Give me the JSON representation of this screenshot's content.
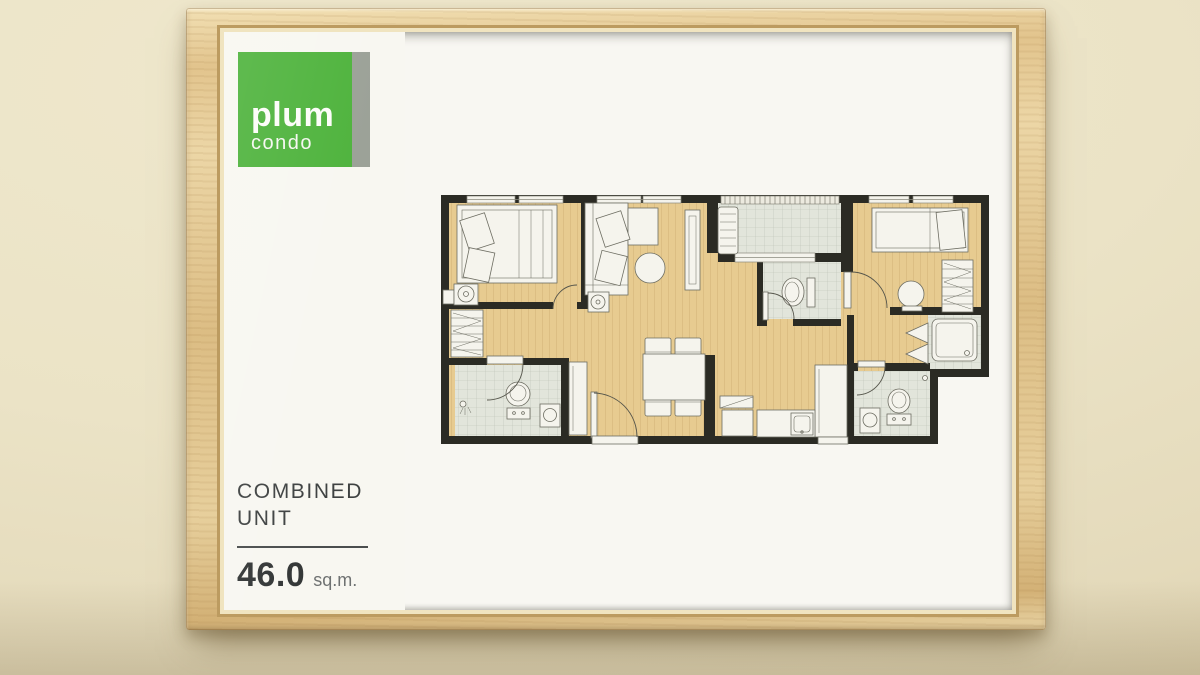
{
  "poster": {
    "brand": {
      "name": "plum",
      "subname": "condo"
    },
    "title_line1": "COMBINED",
    "title_line2": "UNIT",
    "area_value": "46.0",
    "area_unit": "sq.m."
  },
  "colors": {
    "logo_green": "#4cb23a",
    "logo_stripe_gray": "#9aa096",
    "wall_cream": "#ece4c8",
    "frame_wood": "#e2c48d",
    "mat_olive": "#4b4b40",
    "plan_floor_wood": "#e7cb90",
    "plan_walls": "#2b2b24",
    "plan_tile": "#e2e5db",
    "furniture_white": "#f5f4ed"
  },
  "floor_plan": {
    "rooms": [
      "bedroom-left",
      "living-room",
      "balcony",
      "bathroom-middle",
      "bedroom-right",
      "shower-room-right",
      "bathroom-right",
      "bathroom-left",
      "dining-area",
      "kitchen-left",
      "kitchen-right"
    ]
  }
}
